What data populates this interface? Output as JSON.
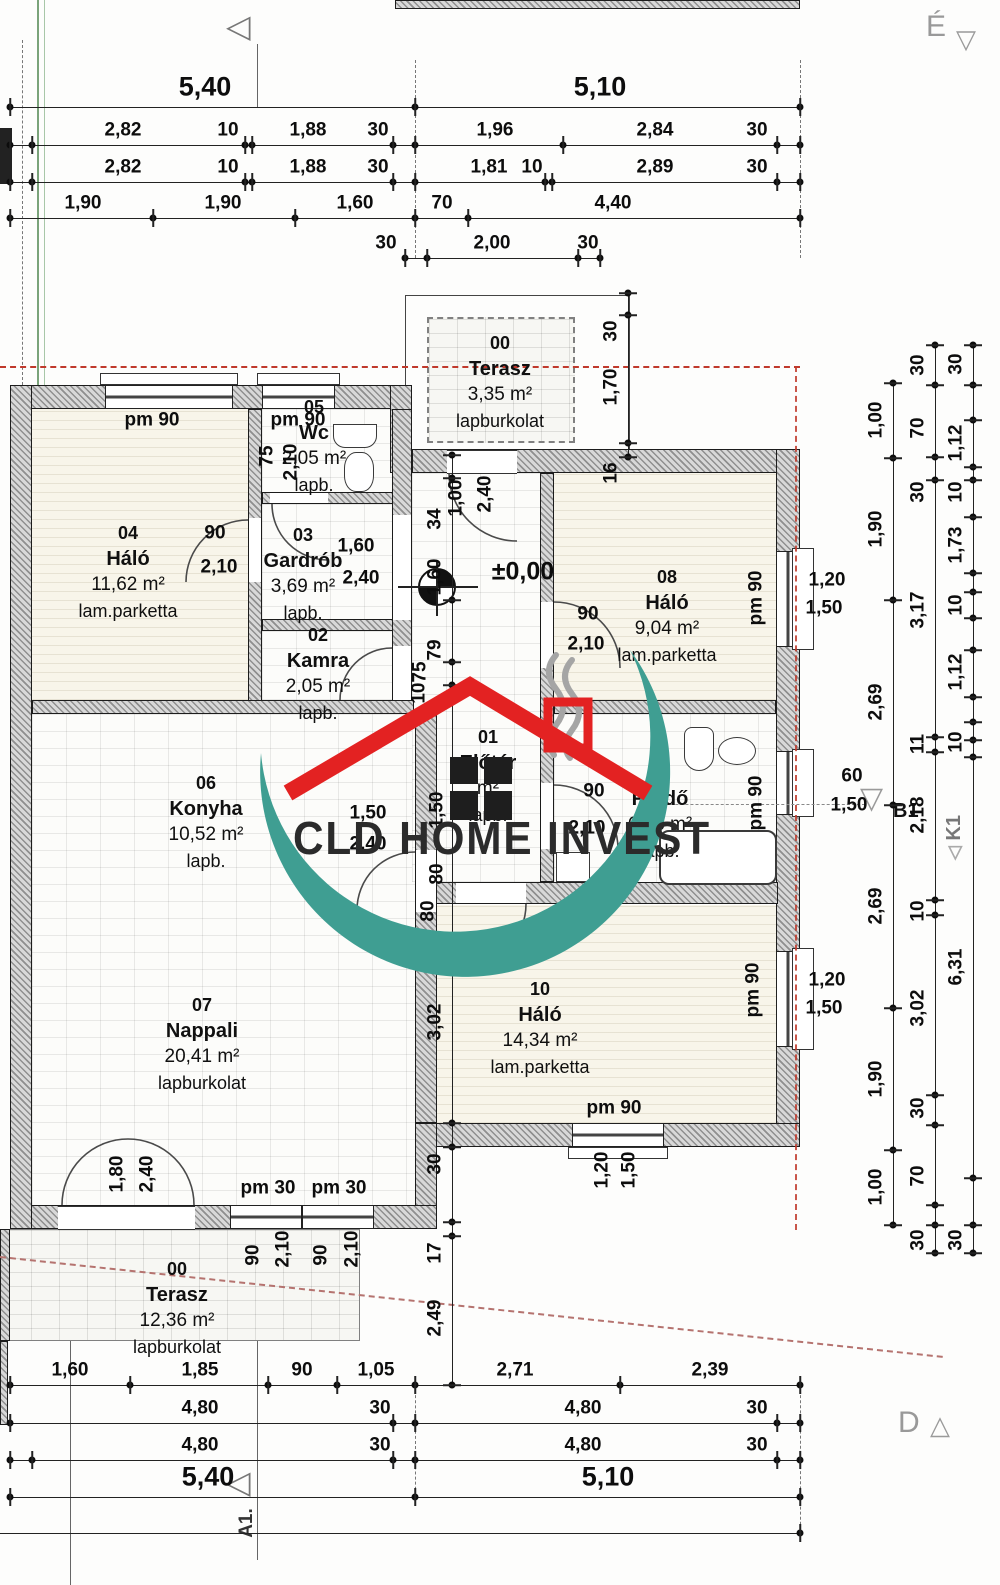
{
  "colors": {
    "watermark_teal": "#3f9e92",
    "watermark_red": "#e32222",
    "axis_red": "#c0392b",
    "boundary_red": "#b5736f"
  },
  "watermark": {
    "text": "CLD HOME INVEST"
  },
  "markers": {
    "north": "É",
    "section_d": "D",
    "axis_b1": "B1",
    "axis_k1": "K1",
    "axis_a1": "A1.",
    "level": "±0,00"
  },
  "icons": {
    "triangle_down": "▽",
    "triangle_up": "△",
    "triangle_left": "◁"
  },
  "rooms": [
    {
      "id": "00",
      "name": "Terasz",
      "area": "3,35 m²",
      "floor": "lapburkolat",
      "cx": 500,
      "top": 330
    },
    {
      "id": "05",
      "name": "Wc",
      "area": "2,05 m²",
      "floor": "lapb.",
      "cx": 314,
      "top": 394
    },
    {
      "id": "04",
      "name": "Háló",
      "area": "11,62 m²",
      "floor": "lam.parketta",
      "cx": 128,
      "top": 520
    },
    {
      "id": "03",
      "name": "Gardrób",
      "area": "3,69 m²",
      "floor": "lapb.",
      "cx": 303,
      "top": 522
    },
    {
      "id": "02",
      "name": "Kamra",
      "area": "2,05 m²",
      "floor": "lapb.",
      "cx": 318,
      "top": 622
    },
    {
      "id": "08",
      "name": "Háló",
      "area": "9,04 m²",
      "floor": "lam.parketta",
      "cx": 667,
      "top": 564
    },
    {
      "id": "06",
      "name": "Konyha",
      "area": "10,52 m²",
      "floor": "lapb.",
      "cx": 206,
      "top": 770
    },
    {
      "id": "01",
      "name": "Előtér",
      "area": "m²",
      "floor": "lapb.",
      "cx": 488,
      "top": 724
    },
    {
      "id": "09",
      "name": "Fürdő",
      "area": "6,23 m²",
      "floor": "lapb.",
      "cx": 660,
      "top": 760
    },
    {
      "id": "07",
      "name": "Nappali",
      "area": "20,41 m²",
      "floor": "lapburkolat",
      "cx": 202,
      "top": 992
    },
    {
      "id": "10",
      "name": "Háló",
      "area": "14,34 m²",
      "floor": "lam.parketta",
      "cx": 540,
      "top": 976
    },
    {
      "id": "00",
      "name": "Terasz",
      "area": "12,36 m²",
      "floor": "lapburkolat",
      "cx": 177,
      "top": 1256
    }
  ],
  "h_dims": [
    {
      "y": 107,
      "x1": 10,
      "x2": 800,
      "cls": "big",
      "labels": [
        {
          "t": "5,40",
          "x": 205
        },
        {
          "t": "5,10",
          "x": 600
        }
      ],
      "ticks": [
        10,
        415,
        800
      ]
    },
    {
      "y": 145,
      "x1": 10,
      "x2": 800,
      "labels": [
        {
          "t": "2,82",
          "x": 123
        },
        {
          "t": "10",
          "x": 228
        },
        {
          "t": "1,88",
          "x": 308
        },
        {
          "t": "30",
          "x": 378
        },
        {
          "t": "1,96",
          "x": 495
        },
        {
          "t": "2,84",
          "x": 655
        },
        {
          "t": "30",
          "x": 757
        }
      ],
      "ticks": [
        10,
        32,
        245,
        252,
        393,
        415,
        563,
        777,
        800
      ]
    },
    {
      "y": 182,
      "x1": 10,
      "x2": 800,
      "labels": [
        {
          "t": "2,82",
          "x": 123
        },
        {
          "t": "10",
          "x": 228
        },
        {
          "t": "1,88",
          "x": 308
        },
        {
          "t": "30",
          "x": 378
        },
        {
          "t": "1,81",
          "x": 489
        },
        {
          "t": "10",
          "x": 532
        },
        {
          "t": "2,89",
          "x": 655
        },
        {
          "t": "30",
          "x": 757
        }
      ],
      "ticks": [
        10,
        32,
        245,
        252,
        393,
        415,
        545,
        552,
        777,
        800
      ]
    },
    {
      "y": 218,
      "x1": 10,
      "x2": 800,
      "labels": [
        {
          "t": "1,90",
          "x": 83
        },
        {
          "t": "1,90",
          "x": 223
        },
        {
          "t": "1,60",
          "x": 355
        },
        {
          "t": "70",
          "x": 442
        },
        {
          "t": "4,40",
          "x": 613
        }
      ],
      "ticks": [
        10,
        153,
        295,
        415,
        468,
        800
      ]
    },
    {
      "y": 258,
      "x1": 405,
      "x2": 600,
      "labels": [
        {
          "t": "30",
          "x": 386
        },
        {
          "t": "2,00",
          "x": 492
        },
        {
          "t": "30",
          "x": 588
        }
      ],
      "ticks": [
        405,
        427,
        578,
        600
      ]
    },
    {
      "y": 1385,
      "x1": 10,
      "x2": 800,
      "labels": [
        {
          "t": "1,60",
          "x": 70
        },
        {
          "t": "1,85",
          "x": 200
        },
        {
          "t": "90",
          "x": 302
        },
        {
          "t": "1,05",
          "x": 376
        },
        {
          "t": "2,71",
          "x": 515
        },
        {
          "t": "2,39",
          "x": 710
        }
      ],
      "ticks": [
        10,
        130,
        268,
        337,
        415,
        620,
        800
      ]
    },
    {
      "y": 1423,
      "x1": 10,
      "x2": 800,
      "labels": [
        {
          "t": "4,80",
          "x": 200
        },
        {
          "t": "30",
          "x": 380
        },
        {
          "t": "4,80",
          "x": 583
        },
        {
          "t": "30",
          "x": 757
        }
      ],
      "ticks": [
        10,
        393,
        415,
        777,
        800
      ]
    },
    {
      "y": 1460,
      "x1": 10,
      "x2": 800,
      "labels": [
        {
          "t": "4,80",
          "x": 200
        },
        {
          "t": "30",
          "x": 380
        },
        {
          "t": "4,80",
          "x": 583
        },
        {
          "t": "30",
          "x": 757
        }
      ],
      "ticks": [
        10,
        32,
        393,
        415,
        777,
        800
      ]
    },
    {
      "y": 1497,
      "x1": 10,
      "x2": 800,
      "cls": "big",
      "labels": [
        {
          "t": "5,40",
          "x": 208
        },
        {
          "t": "5,10",
          "x": 608
        }
      ],
      "ticks": [
        10,
        415,
        800
      ]
    },
    {
      "y": 1533,
      "x1": 0,
      "x2": 800,
      "labels": [],
      "ticks": [
        800
      ]
    }
  ],
  "v_dims": [
    {
      "x": 452,
      "y1": 455,
      "y2": 1385,
      "labels": [
        {
          "t": "34",
          "y": 519
        },
        {
          "t": "1,60",
          "y": 577
        },
        {
          "t": "79",
          "y": 650
        },
        {
          "t": "3,02",
          "y": 1022
        },
        {
          "t": "30",
          "y": 1164
        },
        {
          "t": "17",
          "y": 1253
        },
        {
          "t": "2,49",
          "y": 1318
        }
      ],
      "ticks": [
        455,
        478,
        600,
        662,
        685,
        1123,
        1147,
        1222,
        1236,
        1385
      ]
    },
    {
      "x": 628,
      "y1": 293,
      "y2": 457,
      "labels": [
        {
          "t": "30",
          "y": 331
        },
        {
          "t": "1,70",
          "y": 387
        },
        {
          "t": "16",
          "y": 473
        }
      ],
      "ticks": [
        293,
        315,
        443,
        457
      ]
    },
    {
      "x": 893,
      "y1": 383,
      "y2": 1225,
      "labels": [
        {
          "t": "1,00",
          "y": 420
        },
        {
          "t": "1,90",
          "y": 529
        },
        {
          "t": "2,69",
          "y": 702
        },
        {
          "t": "2,69",
          "y": 906
        },
        {
          "t": "1,90",
          "y": 1079
        },
        {
          "t": "1,00",
          "y": 1187
        }
      ],
      "ticks": [
        383,
        458,
        600,
        805,
        1008,
        1150,
        1225
      ]
    },
    {
      "x": 935,
      "y1": 345,
      "y2": 1253,
      "labels": [
        {
          "t": "30",
          "y": 365
        },
        {
          "t": "70",
          "y": 428
        },
        {
          "t": "30",
          "y": 492
        },
        {
          "t": "3,17",
          "y": 610
        },
        {
          "t": "11",
          "y": 744
        },
        {
          "t": "2,18",
          "y": 815
        },
        {
          "t": "10",
          "y": 911
        },
        {
          "t": "3,02",
          "y": 1008
        },
        {
          "t": "30",
          "y": 1108
        },
        {
          "t": "70",
          "y": 1176
        },
        {
          "t": "30",
          "y": 1240
        }
      ],
      "ticks": [
        345,
        385,
        457,
        480,
        737,
        752,
        900,
        915,
        1095,
        1125,
        1205,
        1225,
        1253
      ]
    },
    {
      "x": 973,
      "y1": 345,
      "y2": 1253,
      "labels": [
        {
          "t": "30",
          "y": 364
        },
        {
          "t": "1,12",
          "y": 443
        },
        {
          "t": "10",
          "y": 492
        },
        {
          "t": "1,73",
          "y": 545
        },
        {
          "t": "10",
          "y": 605
        },
        {
          "t": "1,12",
          "y": 672
        },
        {
          "t": "10",
          "y": 742
        },
        {
          "t": "6,31",
          "y": 967
        },
        {
          "t": "30",
          "y": 1240
        }
      ],
      "ticks": [
        345,
        385,
        420,
        467,
        480,
        517,
        573,
        592,
        618,
        650,
        697,
        722,
        740,
        757,
        1178,
        1225,
        1253
      ]
    }
  ],
  "labels": [
    {
      "t": "75",
      "x": 267,
      "y": 456,
      "r": 1
    },
    {
      "t": "2,10",
      "x": 291,
      "y": 462,
      "r": 1
    },
    {
      "t": "1,00",
      "x": 456,
      "y": 498,
      "r": 1
    },
    {
      "t": "2,40",
      "x": 485,
      "y": 494,
      "r": 1
    },
    {
      "t": "75",
      "x": 420,
      "y": 672,
      "r": 1
    },
    {
      "t": "2,10",
      "x": 419,
      "y": 701,
      "r": 1
    },
    {
      "t": "1,50",
      "x": 437,
      "y": 810,
      "r": 1
    },
    {
      "t": "80",
      "x": 437,
      "y": 874,
      "r": 1
    },
    {
      "t": "80",
      "x": 428,
      "y": 911,
      "r": 1
    },
    {
      "t": "pm 90",
      "x": 152,
      "y": 420
    },
    {
      "t": "pm 90",
      "x": 298,
      "y": 420
    },
    {
      "t": "pm 90",
      "x": 756,
      "y": 598,
      "r": 1
    },
    {
      "t": "pm 90",
      "x": 756,
      "y": 803,
      "r": 1
    },
    {
      "t": "pm 90",
      "x": 753,
      "y": 990,
      "r": 1
    },
    {
      "t": "1,20",
      "x": 827,
      "y": 580
    },
    {
      "t": "1,50",
      "x": 824,
      "y": 608
    },
    {
      "t": "60",
      "x": 852,
      "y": 776
    },
    {
      "t": "1,50",
      "x": 849,
      "y": 805
    },
    {
      "t": "1,20",
      "x": 827,
      "y": 980
    },
    {
      "t": "1,50",
      "x": 824,
      "y": 1008
    },
    {
      "t": "pm 90",
      "x": 614,
      "y": 1108
    },
    {
      "t": "1,20",
      "x": 602,
      "y": 1170,
      "r": 1
    },
    {
      "t": "1,50",
      "x": 629,
      "y": 1170,
      "r": 1
    },
    {
      "t": "1,80",
      "x": 117,
      "y": 1174,
      "r": 1
    },
    {
      "t": "2,40",
      "x": 147,
      "y": 1174,
      "r": 1
    },
    {
      "t": "pm 30",
      "x": 268,
      "y": 1188
    },
    {
      "t": "pm 30",
      "x": 339,
      "y": 1188
    },
    {
      "t": "90",
      "x": 253,
      "y": 1255,
      "r": 1
    },
    {
      "t": "2,10",
      "x": 283,
      "y": 1249,
      "r": 1
    },
    {
      "t": "90",
      "x": 321,
      "y": 1255,
      "r": 1
    },
    {
      "t": "2,10",
      "x": 352,
      "y": 1249,
      "r": 1
    },
    {
      "t": "90",
      "x": 215,
      "y": 533
    },
    {
      "t": "2,10",
      "x": 219,
      "y": 567
    },
    {
      "t": "1,60",
      "x": 356,
      "y": 546
    },
    {
      "t": "2,40",
      "x": 361,
      "y": 578
    },
    {
      "t": "90",
      "x": 588,
      "y": 614
    },
    {
      "t": "2,10",
      "x": 586,
      "y": 644
    },
    {
      "t": "90",
      "x": 594,
      "y": 791
    },
    {
      "t": "2,10",
      "x": 587,
      "y": 828
    },
    {
      "t": "1,50",
      "x": 368,
      "y": 813
    },
    {
      "t": "2,40",
      "x": 368,
      "y": 844
    }
  ]
}
